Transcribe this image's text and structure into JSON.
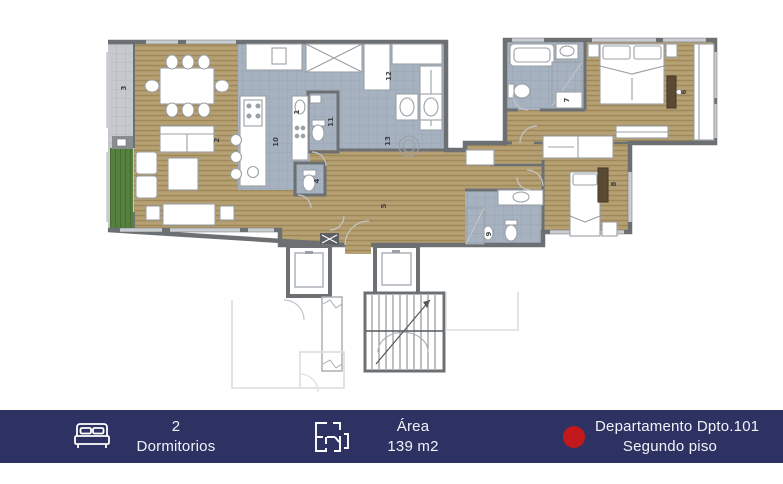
{
  "footer": {
    "bedrooms_count": "2",
    "bedrooms_label": "Dormitorios",
    "area_title": "Área",
    "area_value": "139 m2",
    "unit_line1": "Departamento Dpto.101",
    "unit_line2": "Segundo piso",
    "colors": {
      "bar": "#2d3262",
      "accent_dot": "#c2191c",
      "text": "#f2f3f8"
    }
  },
  "plan": {
    "room_labels": [
      {
        "n": "1"
      },
      {
        "n": "2"
      },
      {
        "n": "3"
      },
      {
        "n": "4"
      },
      {
        "n": "5"
      },
      {
        "n": "6"
      },
      {
        "n": "7"
      },
      {
        "n": "8"
      },
      {
        "n": "9"
      },
      {
        "n": "10"
      },
      {
        "n": "11"
      },
      {
        "n": "12"
      },
      {
        "n": "13"
      }
    ],
    "colors": {
      "wood_floor": "#b19a6c",
      "wet_tile": "#a7b2c0",
      "balcony_tile": "#c5c9cd",
      "planter_green": "#54813e",
      "wall": "#6d7073"
    }
  }
}
